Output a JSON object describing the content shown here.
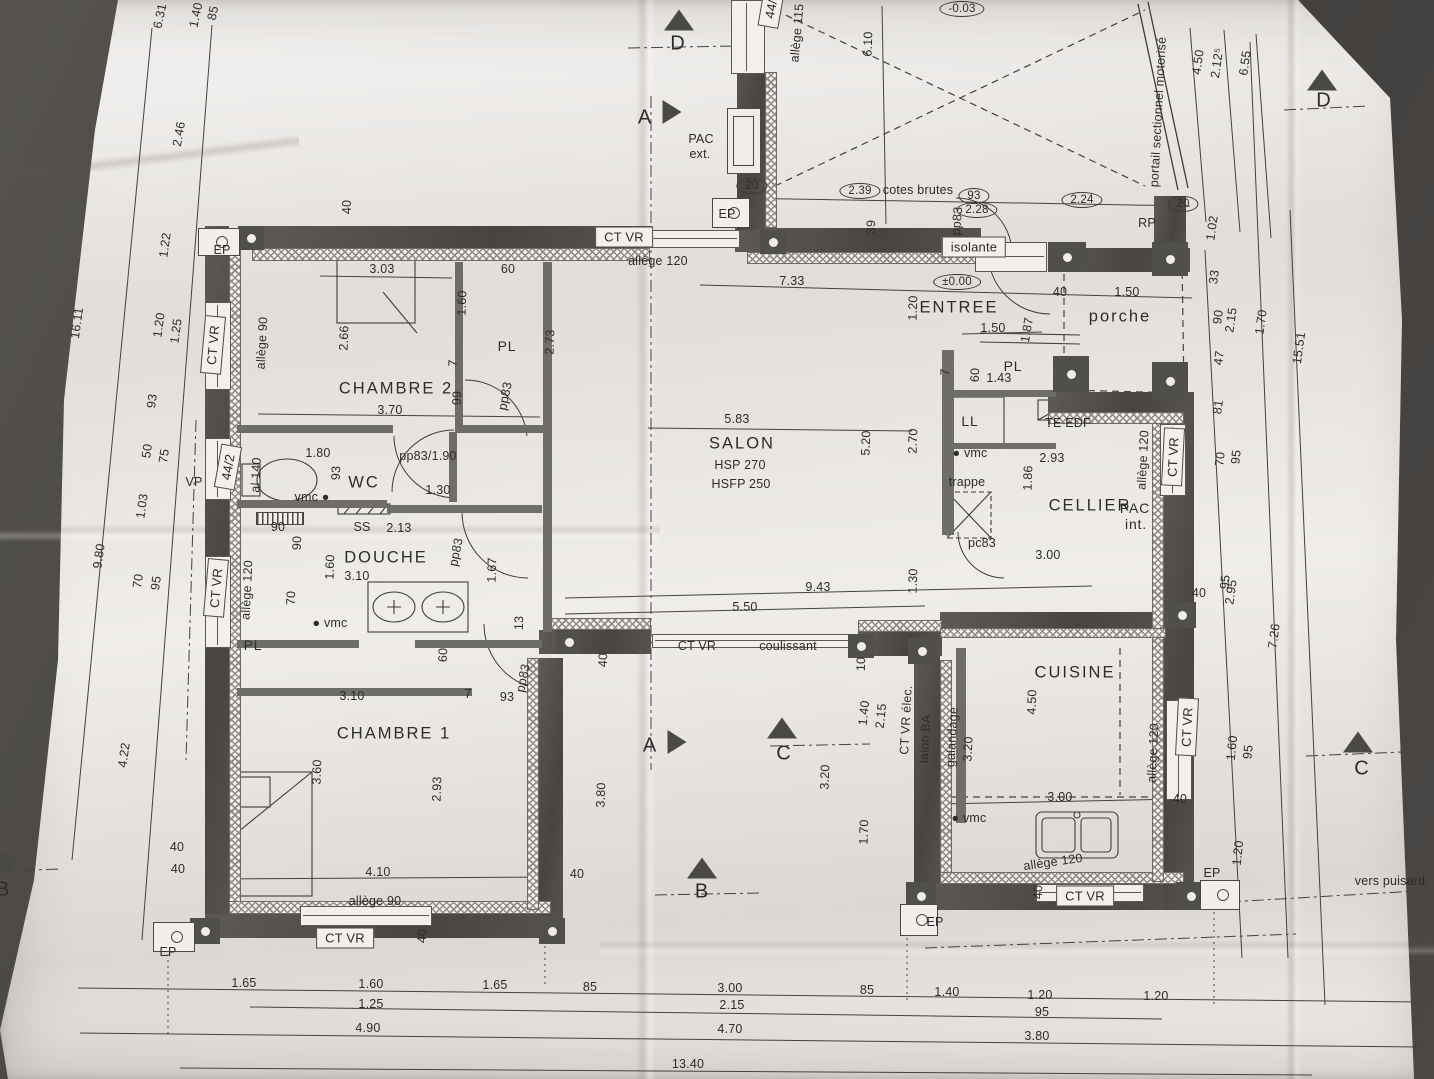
{
  "document": {
    "kind": "floor-plan-photo"
  },
  "colors": {
    "paper": "#ece9e6",
    "background": "#403e3c",
    "wall": "#54524f",
    "ink": "#2e2c2a"
  },
  "rooms": [
    "CHAMBRE 2",
    "WC",
    "DOUCHE",
    "PL",
    "CHAMBRE 1",
    "SALON",
    "ENTREE",
    "CELLIER",
    "CUISINE",
    "porche"
  ],
  "levels": [
    "±0.00",
    "-0.03"
  ],
  "section_letters": [
    "A",
    "B",
    "C",
    "D"
  ],
  "arrows": [
    {
      "x": 679,
      "y": 20,
      "d": "up"
    },
    {
      "x": 1322,
      "y": 80,
      "d": "up"
    },
    {
      "x": 702,
      "y": 868,
      "d": "up"
    },
    {
      "x": 782,
      "y": 728,
      "d": "up"
    },
    {
      "x": 1358,
      "y": 742,
      "d": "up"
    },
    {
      "x": 672,
      "y": 112,
      "d": "right"
    },
    {
      "x": 677,
      "y": 742,
      "d": "right"
    },
    {
      "x": 8,
      "y": 862,
      "d": "right"
    }
  ],
  "labels": [
    {
      "t": "6.31",
      "x": 160,
      "y": 16,
      "r": -78
    },
    {
      "t": "1.40",
      "x": 196,
      "y": 15,
      "r": -78
    },
    {
      "t": "85",
      "x": 213,
      "y": 13,
      "r": -78
    },
    {
      "t": "2.46",
      "x": 179,
      "y": 134,
      "r": -80
    },
    {
      "t": "16.11",
      "x": 77,
      "y": 323,
      "r": -82
    },
    {
      "t": "1.22",
      "x": 165,
      "y": 245,
      "r": -82
    },
    {
      "t": "1.20",
      "x": 159,
      "y": 325,
      "r": -82
    },
    {
      "t": "1.25",
      "x": 176,
      "y": 331,
      "r": -82
    },
    {
      "t": "93",
      "x": 152,
      "y": 401,
      "r": -82
    },
    {
      "t": "50",
      "x": 147,
      "y": 451,
      "r": -82
    },
    {
      "t": "75",
      "x": 164,
      "y": 456,
      "r": -82
    },
    {
      "t": "1.03",
      "x": 142,
      "y": 506,
      "r": -82
    },
    {
      "t": "VP",
      "x": 194,
      "y": 482
    },
    {
      "t": "9.80",
      "x": 99,
      "y": 556,
      "r": -82
    },
    {
      "t": "70",
      "x": 138,
      "y": 581,
      "r": -82
    },
    {
      "t": "95",
      "x": 156,
      "y": 583,
      "r": -82
    },
    {
      "t": "4.22",
      "x": 124,
      "y": 755,
      "r": -82
    },
    {
      "t": "40",
      "x": 177,
      "y": 847
    },
    {
      "t": "EP",
      "x": 168,
      "y": 952
    },
    {
      "t": "40",
      "x": 347,
      "y": 207,
      "r": -90
    },
    {
      "t": "EP",
      "x": 222,
      "y": 250
    },
    {
      "t": "CT VR",
      "x": 624,
      "y": 237,
      "k": "b"
    },
    {
      "t": "allège 120",
      "x": 658,
      "y": 261
    },
    {
      "t": "CT VR",
      "x": 213,
      "y": 345,
      "r": -85,
      "k": "b"
    },
    {
      "t": "allège 90",
      "x": 262,
      "y": 343,
      "r": -87
    },
    {
      "t": "44/2",
      "x": 228,
      "y": 467,
      "r": -80,
      "k": "b"
    },
    {
      "t": "al 140",
      "x": 256,
      "y": 475,
      "r": -87
    },
    {
      "t": "CT VR",
      "x": 216,
      "y": 588,
      "r": -85,
      "k": "b"
    },
    {
      "t": "allège 120",
      "x": 247,
      "y": 590,
      "r": -87
    },
    {
      "t": "3.03",
      "x": 382,
      "y": 269
    },
    {
      "t": "60",
      "x": 508,
      "y": 269
    },
    {
      "t": "2.66",
      "x": 344,
      "y": 338,
      "r": -88
    },
    {
      "t": "1.60",
      "x": 462,
      "y": 303,
      "r": -88
    },
    {
      "t": "PL",
      "x": 507,
      "y": 346,
      "k": "r2"
    },
    {
      "t": "2.73",
      "x": 550,
      "y": 342,
      "r": -88
    },
    {
      "t": "7",
      "x": 453,
      "y": 363,
      "r": -88
    },
    {
      "t": "CHAMBRE 2",
      "x": 396,
      "y": 389,
      "k": "r"
    },
    {
      "t": "3.70",
      "x": 390,
      "y": 410
    },
    {
      "t": "99",
      "x": 457,
      "y": 398,
      "r": -88
    },
    {
      "t": "pp83",
      "x": 505,
      "y": 396,
      "r": -78
    },
    {
      "t": "1.80",
      "x": 318,
      "y": 453
    },
    {
      "t": "pp83/1.90",
      "x": 428,
      "y": 456
    },
    {
      "t": "93",
      "x": 336,
      "y": 473,
      "r": -88
    },
    {
      "t": "WC",
      "x": 364,
      "y": 483,
      "k": "r"
    },
    {
      "t": "1.30",
      "x": 438,
      "y": 490
    },
    {
      "t": "vmc ●",
      "x": 312,
      "y": 497,
      "k": "n"
    },
    {
      "t": "90",
      "x": 278,
      "y": 527
    },
    {
      "t": "90",
      "x": 297,
      "y": 543,
      "r": -88
    },
    {
      "t": "SS",
      "x": 362,
      "y": 527
    },
    {
      "t": "2.13",
      "x": 399,
      "y": 528
    },
    {
      "t": "DOUCHE",
      "x": 386,
      "y": 558,
      "k": "r"
    },
    {
      "t": "3.10",
      "x": 357,
      "y": 576
    },
    {
      "t": "1.60",
      "x": 330,
      "y": 567,
      "r": -88
    },
    {
      "t": "pp83",
      "x": 456,
      "y": 552,
      "r": -78
    },
    {
      "t": "1.67",
      "x": 492,
      "y": 570,
      "r": -88
    },
    {
      "t": "70",
      "x": 291,
      "y": 598,
      "r": -88
    },
    {
      "t": "● vmc",
      "x": 330,
      "y": 623,
      "k": "n"
    },
    {
      "t": "PL",
      "x": 253,
      "y": 645,
      "k": "r2"
    },
    {
      "t": "60",
      "x": 443,
      "y": 655,
      "r": -88
    },
    {
      "t": "3.10",
      "x": 352,
      "y": 696
    },
    {
      "t": "7",
      "x": 468,
      "y": 694
    },
    {
      "t": "93",
      "x": 507,
      "y": 697
    },
    {
      "t": "pp83",
      "x": 523,
      "y": 678,
      "r": -78
    },
    {
      "t": "13",
      "x": 519,
      "y": 623,
      "r": -88
    },
    {
      "t": "CHAMBRE 1",
      "x": 394,
      "y": 734,
      "k": "r"
    },
    {
      "t": "3.60",
      "x": 317,
      "y": 772,
      "r": -88
    },
    {
      "t": "2.93",
      "x": 437,
      "y": 789,
      "r": -88
    },
    {
      "t": "4.10",
      "x": 378,
      "y": 872
    },
    {
      "t": "40",
      "x": 178,
      "y": 869
    },
    {
      "t": "40",
      "x": 577,
      "y": 874
    },
    {
      "t": "allège 90",
      "x": 375,
      "y": 901
    },
    {
      "t": "CT VR",
      "x": 345,
      "y": 938,
      "k": "b"
    },
    {
      "t": "40",
      "x": 422,
      "y": 936,
      "r": -88
    },
    {
      "t": "1.65",
      "x": 244,
      "y": 983
    },
    {
      "t": "1.60",
      "x": 371,
      "y": 984
    },
    {
      "t": "1.65",
      "x": 495,
      "y": 985
    },
    {
      "t": "85",
      "x": 590,
      "y": 987
    },
    {
      "t": "1.25",
      "x": 371,
      "y": 1004
    },
    {
      "t": "4.90",
      "x": 368,
      "y": 1028
    },
    {
      "t": "3.00",
      "x": 730,
      "y": 988
    },
    {
      "t": "85",
      "x": 867,
      "y": 990
    },
    {
      "t": "1.40",
      "x": 947,
      "y": 992
    },
    {
      "t": "1.20",
      "x": 1040,
      "y": 995
    },
    {
      "t": "1.20",
      "x": 1156,
      "y": 996
    },
    {
      "t": "2.15",
      "x": 732,
      "y": 1005
    },
    {
      "t": "95",
      "x": 1042,
      "y": 1012
    },
    {
      "t": "4.70",
      "x": 730,
      "y": 1029
    },
    {
      "t": "3.80",
      "x": 1037,
      "y": 1036
    },
    {
      "t": "13.40",
      "x": 688,
      "y": 1064
    },
    {
      "t": "7.33",
      "x": 792,
      "y": 281
    },
    {
      "t": "±0.00",
      "x": 957,
      "y": 282,
      "k": "o"
    },
    {
      "t": "1.20",
      "x": 913,
      "y": 308,
      "r": -88
    },
    {
      "t": "ENTREE",
      "x": 959,
      "y": 308,
      "k": "r"
    },
    {
      "t": "1.50",
      "x": 993,
      "y": 328
    },
    {
      "t": "1.87",
      "x": 1027,
      "y": 330,
      "r": -80
    },
    {
      "t": "40",
      "x": 1060,
      "y": 292
    },
    {
      "t": "PL",
      "x": 1013,
      "y": 366,
      "k": "r2"
    },
    {
      "t": "60",
      "x": 975,
      "y": 375,
      "r": -88
    },
    {
      "t": "1.43",
      "x": 999,
      "y": 378
    },
    {
      "t": "7",
      "x": 945,
      "y": 372,
      "r": -88
    },
    {
      "t": "LL",
      "x": 970,
      "y": 421,
      "k": "r2"
    },
    {
      "t": "TE EDF",
      "x": 1068,
      "y": 423,
      "k": "n"
    },
    {
      "t": "5.83",
      "x": 737,
      "y": 419
    },
    {
      "t": "SALON",
      "x": 742,
      "y": 444,
      "k": "r"
    },
    {
      "t": "5.20",
      "x": 866,
      "y": 443,
      "r": -88
    },
    {
      "t": "2.70",
      "x": 913,
      "y": 441,
      "r": -88
    },
    {
      "t": "HSP 270",
      "x": 740,
      "y": 465,
      "k": "n"
    },
    {
      "t": "HSFP 250",
      "x": 741,
      "y": 484,
      "k": "n"
    },
    {
      "t": "● vmc",
      "x": 970,
      "y": 453,
      "k": "n"
    },
    {
      "t": "2.93",
      "x": 1052,
      "y": 458
    },
    {
      "t": "trappe",
      "x": 967,
      "y": 482,
      "k": "n"
    },
    {
      "t": "1.86",
      "x": 1028,
      "y": 478,
      "r": -88
    },
    {
      "t": "CELLIER",
      "x": 1090,
      "y": 506,
      "k": "r"
    },
    {
      "t": "pc83",
      "x": 982,
      "y": 543
    },
    {
      "t": "3.00",
      "x": 1048,
      "y": 555
    },
    {
      "t": "PAC",
      "x": 1135,
      "y": 508,
      "k": "r2"
    },
    {
      "t": "int.",
      "x": 1136,
      "y": 524,
      "k": "r2"
    },
    {
      "t": "D",
      "x": 678,
      "y": 44,
      "k": "s"
    },
    {
      "t": "A",
      "x": 645,
      "y": 118,
      "k": "s"
    },
    {
      "t": "PAC",
      "x": 701,
      "y": 139,
      "k": "n"
    },
    {
      "t": "ext.",
      "x": 700,
      "y": 154,
      "k": "n"
    },
    {
      "t": "44/",
      "x": 771,
      "y": 9,
      "r": -80,
      "k": "b"
    },
    {
      "t": "allège 115",
      "x": 797,
      "y": 33,
      "r": -85
    },
    {
      "t": "6.10",
      "x": 868,
      "y": 44,
      "r": -88
    },
    {
      "t": "-0.03",
      "x": 962,
      "y": 9,
      "k": "o"
    },
    {
      "t": "20",
      "x": 752,
      "y": 186,
      "k": "o"
    },
    {
      "t": "2.39",
      "x": 860,
      "y": 191,
      "k": "o"
    },
    {
      "t": "cotes brutes",
      "x": 918,
      "y": 190,
      "k": "n"
    },
    {
      "t": "93",
      "x": 974,
      "y": 196,
      "k": "o"
    },
    {
      "t": "2.28",
      "x": 977,
      "y": 210,
      "k": "o"
    },
    {
      "t": "EP",
      "x": 727,
      "y": 214
    },
    {
      "t": "39",
      "x": 871,
      "y": 227,
      "r": -88
    },
    {
      "t": "pp83",
      "x": 957,
      "y": 221,
      "r": -85
    },
    {
      "t": "isolante",
      "x": 974,
      "y": 247,
      "k": "b"
    },
    {
      "t": "2.24",
      "x": 1082,
      "y": 200,
      "k": "o"
    },
    {
      "t": "20",
      "x": 1183,
      "y": 204,
      "k": "o"
    },
    {
      "t": "RP",
      "x": 1147,
      "y": 223
    },
    {
      "t": "1.02",
      "x": 1212,
      "y": 228,
      "r": -82
    },
    {
      "t": "portail sectionnel motorisé",
      "x": 1158,
      "y": 112,
      "r": -87,
      "k": "n"
    },
    {
      "t": "4.50",
      "x": 1198,
      "y": 62,
      "r": -82
    },
    {
      "t": "2.12⁵",
      "x": 1217,
      "y": 63,
      "r": -82
    },
    {
      "t": "6.55",
      "x": 1245,
      "y": 63,
      "r": -82
    },
    {
      "t": "D",
      "x": 1324,
      "y": 101,
      "k": "s"
    },
    {
      "t": "33",
      "x": 1214,
      "y": 277,
      "r": -82
    },
    {
      "t": "1.50",
      "x": 1127,
      "y": 292
    },
    {
      "t": "porche",
      "x": 1120,
      "y": 317,
      "k": "r"
    },
    {
      "t": "90",
      "x": 1218,
      "y": 317,
      "r": -82
    },
    {
      "t": "2.15",
      "x": 1231,
      "y": 320,
      "r": -82
    },
    {
      "t": "1.70",
      "x": 1261,
      "y": 322,
      "r": -82
    },
    {
      "t": "15.51",
      "x": 1299,
      "y": 348,
      "r": -82
    },
    {
      "t": "47",
      "x": 1219,
      "y": 358,
      "r": -82
    },
    {
      "t": "81",
      "x": 1218,
      "y": 407,
      "r": -82
    },
    {
      "t": "allège 120",
      "x": 1143,
      "y": 460,
      "r": -87
    },
    {
      "t": "CT VR",
      "x": 1173,
      "y": 457,
      "r": -87,
      "k": "b"
    },
    {
      "t": "70",
      "x": 1220,
      "y": 459,
      "r": -84
    },
    {
      "t": "95",
      "x": 1236,
      "y": 457,
      "r": -84
    },
    {
      "t": "95",
      "x": 1225,
      "y": 582,
      "r": -84
    },
    {
      "t": "2.95",
      "x": 1231,
      "y": 592,
      "r": -82
    },
    {
      "t": "40",
      "x": 1199,
      "y": 593
    },
    {
      "t": "9.43",
      "x": 818,
      "y": 587
    },
    {
      "t": "5.50",
      "x": 745,
      "y": 607
    },
    {
      "t": "1.30",
      "x": 913,
      "y": 581,
      "r": -88
    },
    {
      "t": "40",
      "x": 603,
      "y": 660,
      "r": -88
    },
    {
      "t": "CT VR",
      "x": 697,
      "y": 646,
      "k": "n"
    },
    {
      "t": "coulissant",
      "x": 788,
      "y": 646,
      "k": "n"
    },
    {
      "t": "10",
      "x": 861,
      "y": 664,
      "r": -88
    },
    {
      "t": "A",
      "x": 650,
      "y": 746,
      "k": "s"
    },
    {
      "t": "C",
      "x": 784,
      "y": 754,
      "k": "s"
    },
    {
      "t": "1.40",
      "x": 864,
      "y": 713,
      "r": -84
    },
    {
      "t": "2.15",
      "x": 881,
      "y": 716,
      "r": -84
    },
    {
      "t": "CT VR élec.",
      "x": 906,
      "y": 720,
      "r": -87,
      "k": "n"
    },
    {
      "t": "talon BA",
      "x": 925,
      "y": 739,
      "r": -87,
      "k": "n"
    },
    {
      "t": "galandage",
      "x": 952,
      "y": 737,
      "r": -87,
      "k": "n"
    },
    {
      "t": "3.20",
      "x": 968,
      "y": 749,
      "r": -87
    },
    {
      "t": "3.20",
      "x": 825,
      "y": 777,
      "r": -88
    },
    {
      "t": "3.80",
      "x": 601,
      "y": 795,
      "r": -88
    },
    {
      "t": "1.70",
      "x": 864,
      "y": 832,
      "r": -88
    },
    {
      "t": "B",
      "x": 702,
      "y": 892,
      "k": "s"
    },
    {
      "t": "B",
      "x": 3,
      "y": 890,
      "k": "s"
    },
    {
      "t": "CUISINE",
      "x": 1075,
      "y": 673,
      "k": "r"
    },
    {
      "t": "4.50",
      "x": 1032,
      "y": 702,
      "r": -88
    },
    {
      "t": "3.00",
      "x": 1060,
      "y": 797
    },
    {
      "t": "40",
      "x": 1180,
      "y": 799
    },
    {
      "t": "● vmc",
      "x": 969,
      "y": 818,
      "k": "n"
    },
    {
      "t": "allège 120",
      "x": 1053,
      "y": 862,
      "r": -8,
      "k": "n"
    },
    {
      "t": "allège 120",
      "x": 1153,
      "y": 753,
      "r": -87
    },
    {
      "t": "CT VR",
      "x": 1187,
      "y": 727,
      "r": -87,
      "k": "b"
    },
    {
      "t": "CT VR",
      "x": 1085,
      "y": 896,
      "k": "b"
    },
    {
      "t": "40",
      "x": 1038,
      "y": 892,
      "r": -88
    },
    {
      "t": "EP",
      "x": 935,
      "y": 922
    },
    {
      "t": "EP",
      "x": 1212,
      "y": 873
    },
    {
      "t": "1.60",
      "x": 1232,
      "y": 748,
      "r": -84
    },
    {
      "t": "95",
      "x": 1248,
      "y": 752,
      "r": -84
    },
    {
      "t": "1.20",
      "x": 1238,
      "y": 853,
      "r": -84
    },
    {
      "t": "7.26",
      "x": 1274,
      "y": 636,
      "r": -82
    },
    {
      "t": "vers puisard",
      "x": 1390,
      "y": 881,
      "k": "n"
    },
    {
      "t": "C",
      "x": 1362,
      "y": 769,
      "k": "s"
    }
  ]
}
